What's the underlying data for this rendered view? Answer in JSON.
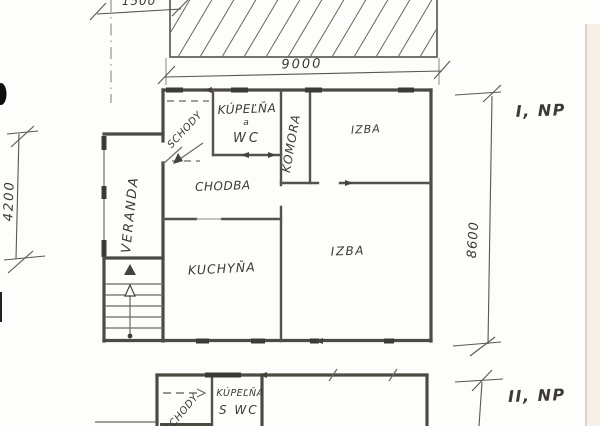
{
  "palette": {
    "ink": "#4d4a44",
    "ink_dark": "#3c3a35",
    "ink_light": "#8a867e",
    "paper": "#fdfdfc",
    "paper_edge": "#f5f1e6",
    "edge_line": "#c2bdb1",
    "artifact_black": "#0e0e0e"
  },
  "floor_plan_1": {
    "floor_label": "I, NP",
    "rooms": {
      "schody": "SCHODY",
      "kupelna_line1": "KÚPEĽŇA",
      "kupelna_line2": "a",
      "kupelna_line3": "WC",
      "komora": "KOMORA",
      "izba_top": "IZBA",
      "chodba": "CHODBA",
      "veranda": "VERANDA",
      "kuchyna": "KUCHYŇA",
      "izba_big": "IZBA"
    },
    "dimensions": {
      "top_offset": "1500",
      "top_width": "9000",
      "left_height": "4200",
      "right_height": "8600"
    }
  },
  "floor_plan_2": {
    "floor_label": "II, NP",
    "rooms": {
      "schody": "SCHODY",
      "kupelna_line1": "KÚPEĽŇA",
      "kupelna_line2": "S WC"
    }
  }
}
